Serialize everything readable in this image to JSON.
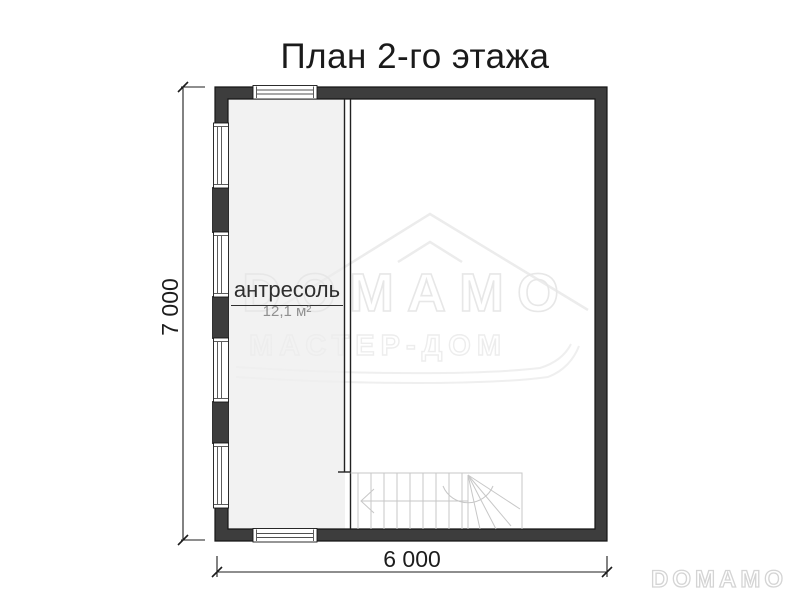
{
  "title": "План 2-го этажа",
  "plan": {
    "room": {
      "name": "антресоль",
      "area": "12,1 м²"
    },
    "width_label": "6 000",
    "height_label": "7 000"
  },
  "watermark": {
    "brand": "DOMAMO",
    "subtitle": "МАСТЕР-ДОМ"
  },
  "footer": {
    "logo": "DOMAMO"
  },
  "icons": {
    "windows": "window-icon",
    "stairs": "stairs-icon",
    "roof": "roof-outline-icon"
  },
  "colors": {
    "wall_fill": "#3d3d3d",
    "wall_outline": "#161616",
    "room_fill": "#f2f2f2",
    "stair_lines": "#c7c7c7",
    "dimension": "#1c1c1c",
    "watermark_outline": "#e9e9e9",
    "footer_logo_outline": "#d4d4d4",
    "area_text": "#909090"
  }
}
